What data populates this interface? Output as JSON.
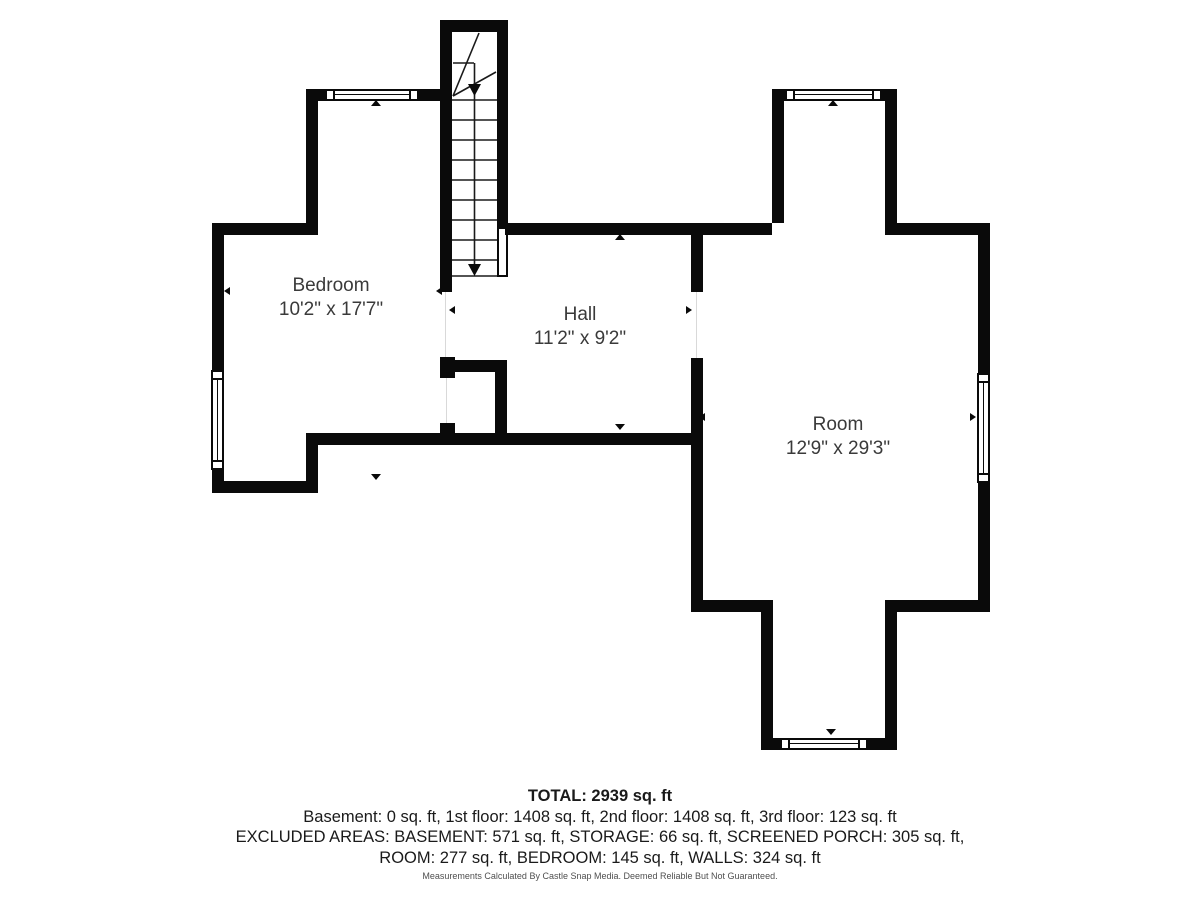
{
  "plan": {
    "rooms": [
      {
        "name": "Bedroom",
        "dimensions": "10'2\" x 17'7\""
      },
      {
        "name": "Hall",
        "dimensions": "11'2\" x 9'2\""
      },
      {
        "name": "Room",
        "dimensions": "12'9\" x 29'3\""
      }
    ],
    "colors": {
      "wall": "#0a0a0a",
      "label_text": "#3a3a3a",
      "summary_text": "#1a1a1a",
      "background": "#ffffff"
    }
  },
  "summary": {
    "total": "TOTAL: 2939 sq. ft",
    "floors": "Basement: 0 sq. ft, 1st floor: 1408 sq. ft, 2nd floor: 1408 sq. ft, 3rd floor: 123 sq. ft",
    "excluded_line1": "EXCLUDED AREAS: BASEMENT: 571 sq. ft, STORAGE: 66 sq. ft, SCREENED PORCH: 305 sq. ft,",
    "excluded_line2": "ROOM: 277 sq. ft, BEDROOM: 145 sq. ft, WALLS: 324 sq. ft",
    "disclaimer": "Measurements Calculated By Castle Snap Media. Deemed Reliable But Not Guaranteed."
  }
}
